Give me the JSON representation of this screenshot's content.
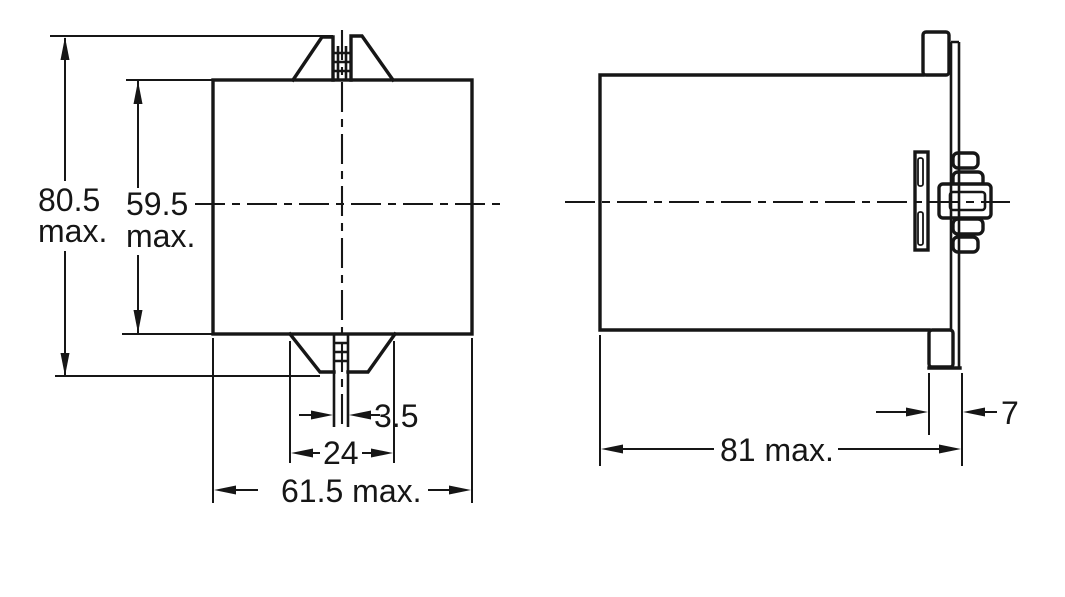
{
  "drawing": {
    "background_color": "#ffffff",
    "line_color": "#161616",
    "front_view": {
      "total_height": {
        "value": "80.5",
        "suffix": "max."
      },
      "body_height": {
        "value": "59.5",
        "suffix": "max."
      },
      "slot_width": "3.5",
      "latch_width": "24",
      "body_width": "61.5 max."
    },
    "side_view": {
      "flange_depth": "7",
      "total_depth": "81 max."
    }
  }
}
